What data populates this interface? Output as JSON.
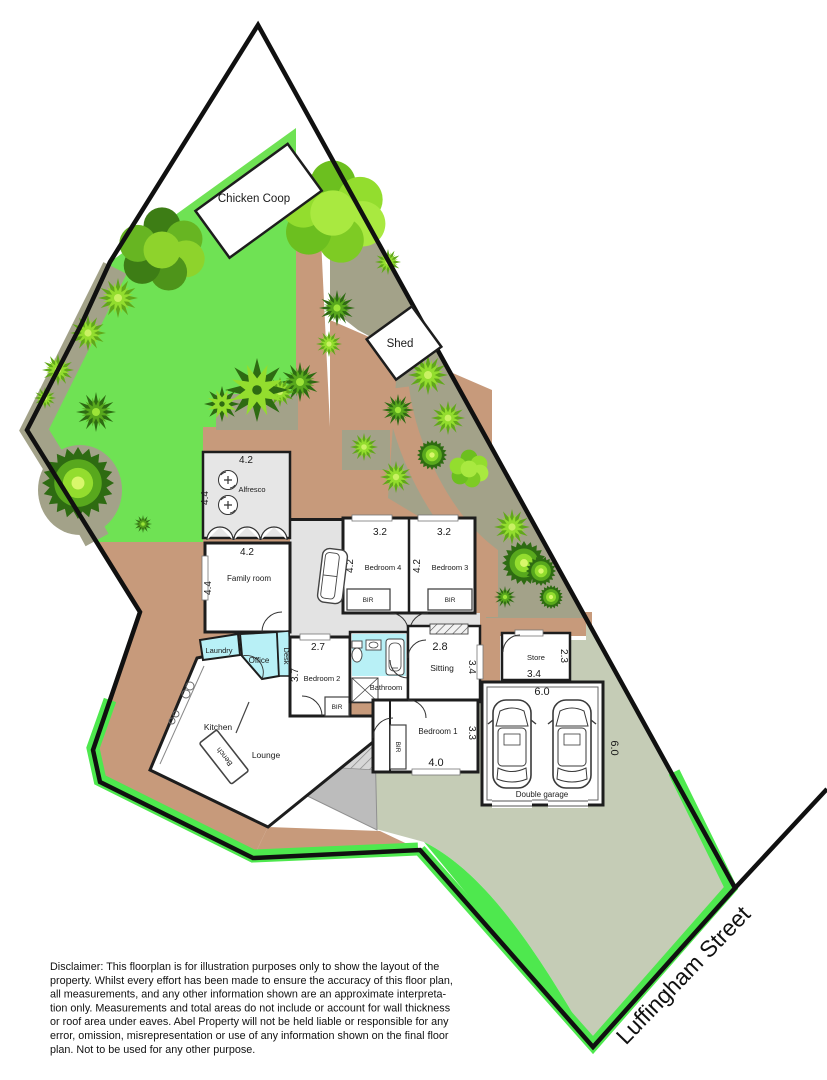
{
  "site": {
    "street": "Luffingham Street",
    "chicken_coop": "Chicken Coop",
    "shed": "Shed"
  },
  "rooms": {
    "alfresco": {
      "label": "Alfresco",
      "width": "4.2",
      "depth": "4.4"
    },
    "family_room": {
      "label": "Family room",
      "width": "4.2",
      "depth": "4.4"
    },
    "bedroom4": {
      "label": "Bedroom 4",
      "width": "3.2",
      "depth": "4.2",
      "robe": "BIR"
    },
    "bedroom3": {
      "label": "Bedroom 3",
      "width": "3.2",
      "depth": "4.2",
      "robe": "BIR"
    },
    "bedroom2": {
      "label": "Bedroom 2",
      "width": "2.7",
      "depth": "3.7",
      "robe": "BIR"
    },
    "bedroom1": {
      "label": "Bedroom 1",
      "width": "4.0",
      "depth": "3.3",
      "robe": "BIR"
    },
    "sitting": {
      "label": "Sitting",
      "width": "2.8",
      "depth": "3.4"
    },
    "store": {
      "label": "Store",
      "width": "3.4",
      "depth": "2.3"
    },
    "double_garage": {
      "label": "Double garage",
      "width": "6.0",
      "depth": "6.0"
    },
    "bathroom": {
      "label": "Bathroom"
    },
    "laundry": {
      "label": "Laundry"
    },
    "office": {
      "label": "Office"
    },
    "desk": {
      "label": "Desk"
    },
    "kitchen": {
      "label": "Kitchen"
    },
    "lounge": {
      "label": "Lounge"
    },
    "bench": {
      "label": "Bench"
    }
  },
  "disclaimer": {
    "lines": [
      "Disclaimer:  This floorplan is for illustration purposes only to show the layout of the",
      "property. Whilst every effort has been made to ensure the accuracy of this floor plan,",
      "all measurements, and any other information shown are an approximate interpreta-",
      "tion only. Measurements and total areas do not include or account for wall thickness",
      "or roof area under eaves. Abel Property will not be held liable or responsible for any",
      "error, omission, misrepresentation or use of any information shown on the final floor",
      "plan. Not to be used for any other purpose."
    ]
  },
  "colors": {
    "lawn": "#6fe254",
    "verge_strip": "#4ee84e",
    "path_brown": "#c79a7b",
    "garden_bed": "#a3a289",
    "driveway_sage": "#c5ccb6",
    "wet_area_cyan": "#b8f0f6",
    "hall_grey": "#e3e3e3",
    "wall": "#1d1d1d",
    "tree_lime": "#93dd2e",
    "tree_dark": "#2e6b12"
  }
}
